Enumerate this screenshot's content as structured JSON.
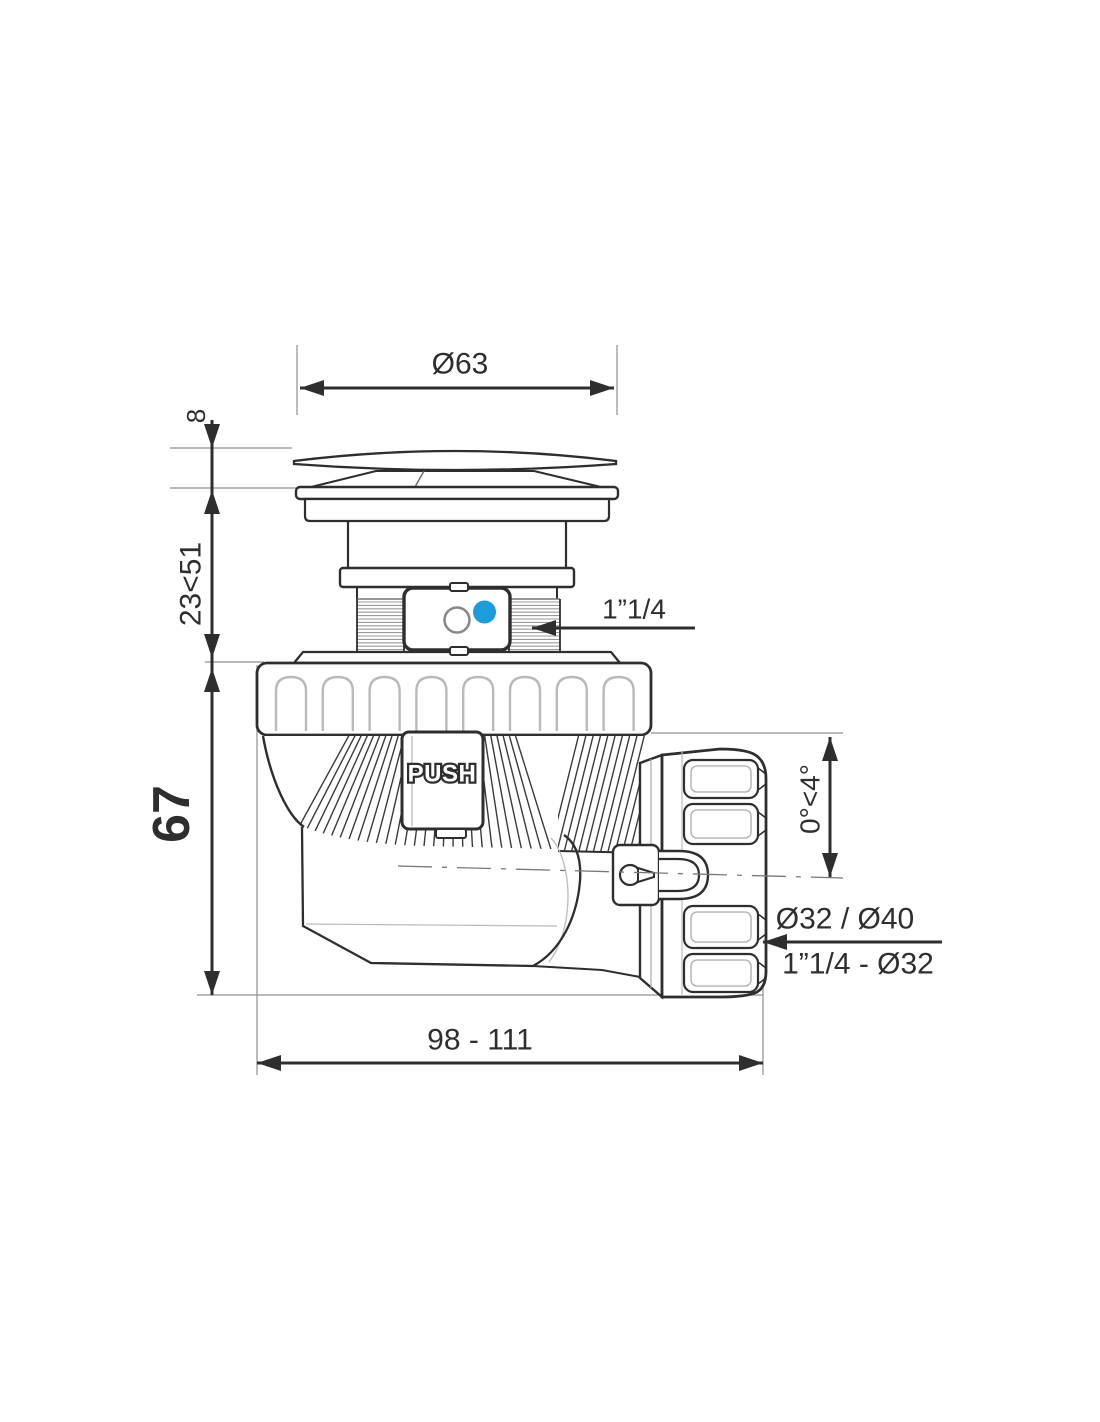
{
  "colors": {
    "line": "#2e2e2e",
    "accent_blue": "#1b9dd9",
    "detail_gray": "#9a9a9a"
  },
  "drawing": {
    "dim_cap_diameter": "Ø63",
    "dim_cap_thickness": "8",
    "dim_adjustable_height": "23<51",
    "dim_body_height": "67",
    "dim_inlet_thread": "1”1/4",
    "dim_outlet_angle": "0°<4°",
    "dim_outlet_sizes_top": "Ø32 / Ø40",
    "dim_outlet_sizes_bottom": "1”1/4 - Ø32",
    "dim_total_length": "98 - 111",
    "push_label": "PUSH"
  }
}
